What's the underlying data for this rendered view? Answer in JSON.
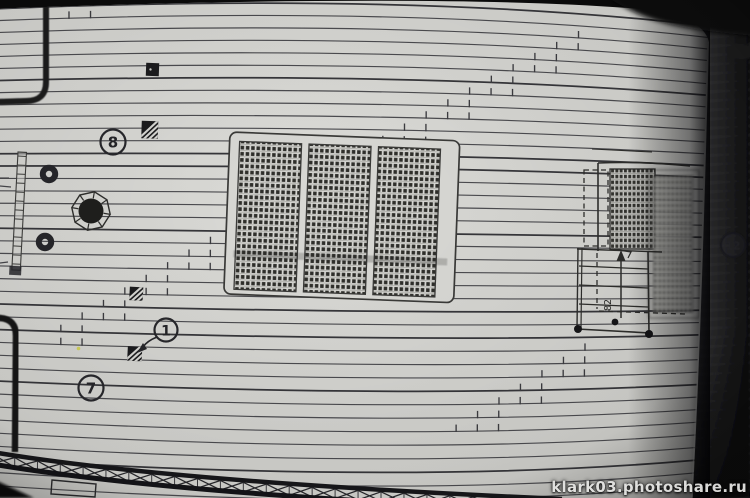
{
  "page": {
    "watermark": "klark03.photoshare.ru"
  },
  "plan": {
    "callouts": {
      "c8": "8",
      "c1": "1",
      "c7": "7",
      "c12": "12"
    },
    "dimension": "82",
    "grating_panel_count": 3,
    "symbols": [
      "solid-square-marker",
      "hatched-square-marker",
      "ring-fitting",
      "octagon-mast-hole",
      "ladder-strip",
      "deck-grating",
      "cross-brace-railing"
    ],
    "colors": {
      "paper": "#d3d3cf",
      "ink": "#4a4a48",
      "photo_background": "#0a0a0a",
      "second_page": "#3a3a3c",
      "watermark_text": "#e4e4e2",
      "speck_yellow": "#cdcd45"
    }
  }
}
